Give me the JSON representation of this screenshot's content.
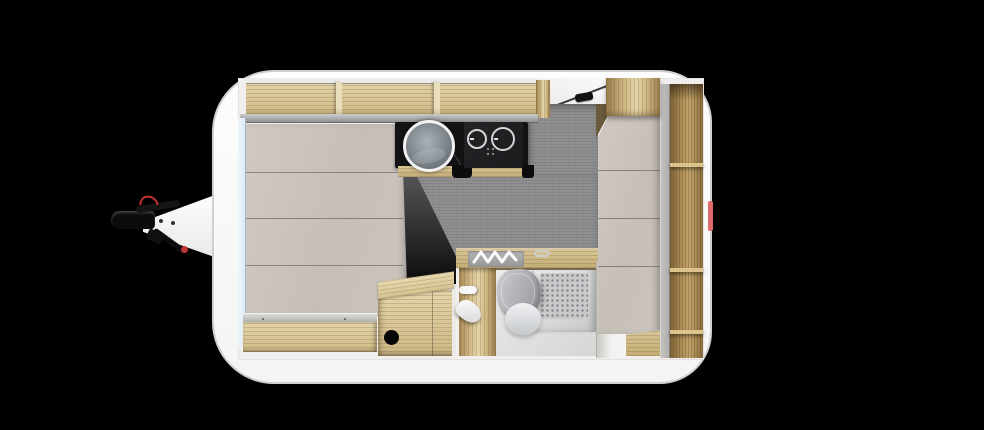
{
  "scene": {
    "description": "Top-down 3D rendered floor plan of a single-axle travel caravan on a black background",
    "view": "top-down floor plan render",
    "visible_text": "none"
  },
  "colors": {
    "background": "#000000",
    "shell_white": "#fafafa",
    "shell_outline": "#d0d0d0",
    "interior_floor": "#f0efed",
    "wood_light": "#e4d5ab",
    "wood_mid": "#cfb985",
    "wood_dark": "#9a7c4a",
    "cushion_beige": "#c9c2bb",
    "lip_gray": "#9b9c9e",
    "floor_gray": "#8d8d8f",
    "marble_black": "#131316",
    "hob_black": "#1c1c1f",
    "dark_shadow_wall": "#222224",
    "steel_gray": "#a9abad",
    "toilet_gray": "#a8aaae",
    "shower_gray": "#d5d5d7",
    "window_blue": "#dceaf4",
    "hitch_black": "#0c0c0e",
    "accent_red": "#c53030",
    "marker_red": "#e06a6a"
  },
  "components": {
    "caravan_body": "white rounded body shell",
    "tow_hitch": "A-frame drawbar with coupling head, red breakaway cable and jockey-wheel handle",
    "overhead_lockers": "open oak overhead shelves along front wall",
    "lounge_bed": "front lounge bed with beige cushions and oak bench base",
    "kitchen": "black marble kitchenette with round sink and two-burner hob",
    "hallway_floor": "grey textured floor between kitchen and wardrobe",
    "entry_door": "entry opening with dark handle, top right",
    "bathroom": "washroom with oak vanity, folding tap, cassette toilet and shower tray",
    "wardrobe": "oak wardrobe column and open shelving along rear wall",
    "step_cabinet": "oak step cabinet with round cut-out"
  }
}
